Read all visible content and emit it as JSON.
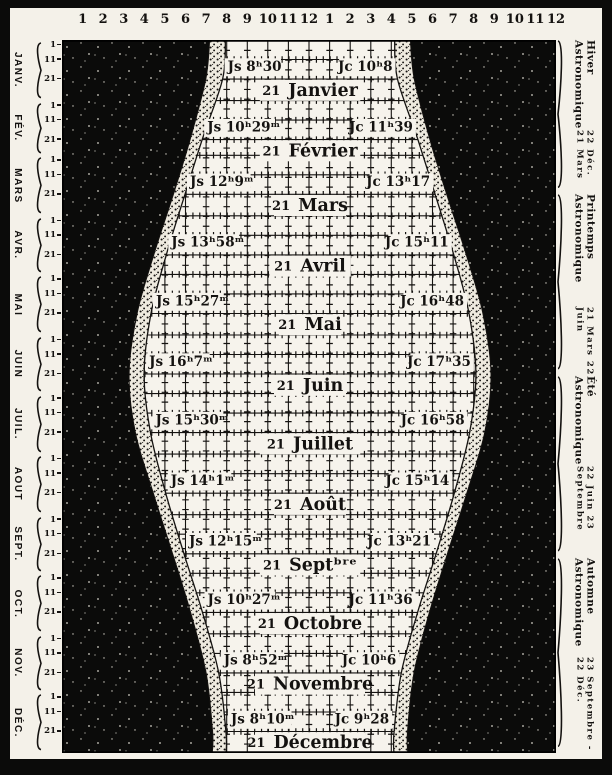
{
  "colors": {
    "paper": "#f4f1e9",
    "day": "#f6f3ec",
    "night": "#0b0b0a",
    "ink": "#141210",
    "speckle": "#d3d0c6"
  },
  "top_axis": {
    "hours": [
      "1",
      "2",
      "3",
      "4",
      "5",
      "6",
      "7",
      "8",
      "9",
      "10",
      "11",
      "12",
      "1",
      "2",
      "3",
      "4",
      "5",
      "6",
      "7",
      "8",
      "9",
      "10",
      "11",
      "12"
    ]
  },
  "left_margin": {
    "tick_labels": [
      "1",
      "11",
      "21"
    ]
  },
  "right_margin": {
    "seasons": [
      {
        "name": "Hiver Astronomique",
        "dates": "22 Déc. 21 Mars",
        "span_days": [
          0,
          79
        ]
      },
      {
        "name": "Printemps Astronomique",
        "dates": "21 Mars 22 Juin",
        "span_days": [
          79,
          172
        ]
      },
      {
        "name": "Été Astronomique",
        "dates": "22 Juin 23 Septembre",
        "span_days": [
          172,
          265
        ]
      },
      {
        "name": "Automne Astronomique",
        "dates": "23 Septembre - 22 Déc.",
        "span_days": [
          265,
          365
        ]
      }
    ]
  },
  "chart_data": {
    "type": "area",
    "x_axis": {
      "unit": "heures",
      "range": [
        0,
        24
      ],
      "tick_labels": [
        "1",
        "2",
        "3",
        "4",
        "5",
        "6",
        "7",
        "8",
        "9",
        "10",
        "11",
        "12",
        "1",
        "2",
        "3",
        "4",
        "5",
        "6",
        "7",
        "8",
        "9",
        "10",
        "11",
        "12"
      ]
    },
    "y_axis": {
      "unit": "jours de l'année",
      "range_days": [
        0,
        365
      ],
      "day_ticks_per_month": [
        "1",
        "11",
        "21"
      ]
    },
    "regions": [
      "nuit",
      "crépuscule",
      "jour"
    ],
    "day_center_hour": 12.05,
    "grid": {
      "vertical_every_hours": 1,
      "horizontal_every_days": 10
    },
    "months": [
      {
        "abbr": "JANV.",
        "name": "Janvier",
        "label_day": "21",
        "start_day": 0,
        "len": 31,
        "js": "Js 8ʰ30",
        "jc": "Jc 10ʰ8",
        "js_hours": 8.5,
        "jc_hours": 10.13
      },
      {
        "abbr": "FÉV.",
        "name": "Février",
        "label_day": "21",
        "start_day": 31,
        "len": 28,
        "js": "Js 10ʰ29ᵐ",
        "jc": "Jc 11ʰ39",
        "js_hours": 10.48,
        "jc_hours": 11.65
      },
      {
        "abbr": "MARS",
        "name": "Mars",
        "label_day": "21",
        "start_day": 59,
        "len": 31,
        "js": "Js 12ʰ9ᵐ",
        "jc": "Jc 13ʰ17",
        "js_hours": 12.15,
        "jc_hours": 13.28
      },
      {
        "abbr": "AVR.",
        "name": "Avril",
        "label_day": "21",
        "start_day": 90,
        "len": 30,
        "js": "Js 13ʰ58ᵐ",
        "jc": "Jc 15ʰ11",
        "js_hours": 13.97,
        "jc_hours": 15.18
      },
      {
        "abbr": "MAI",
        "name": "Mai",
        "label_day": "21",
        "start_day": 120,
        "len": 31,
        "js": "Js 15ʰ27ᵐ",
        "jc": "Jc 16ʰ48",
        "js_hours": 15.45,
        "jc_hours": 16.8
      },
      {
        "abbr": "JUIN",
        "name": "Juin",
        "label_day": "21",
        "start_day": 151,
        "len": 30,
        "js": "Js 16ʰ7ᵐ",
        "jc": "Jc 17ʰ35",
        "js_hours": 16.12,
        "jc_hours": 17.58
      },
      {
        "abbr": "JUIL.",
        "name": "Juillet",
        "label_day": "21",
        "start_day": 181,
        "len": 31,
        "js": "Js 15ʰ30ᵐ",
        "jc": "Jc 16ʰ58",
        "js_hours": 15.5,
        "jc_hours": 16.97
      },
      {
        "abbr": "AOUT",
        "name": "Août",
        "label_day": "21",
        "start_day": 212,
        "len": 31,
        "js": "Js 14ʰ1ᵐ",
        "jc": "Jc 15ʰ14",
        "js_hours": 14.02,
        "jc_hours": 15.23
      },
      {
        "abbr": "SEPT.",
        "name": "Septᵇʳᵉ",
        "label_day": "21",
        "start_day": 243,
        "len": 30,
        "js": "Js 12ʰ15ᵐ",
        "jc": "Jc 13ʰ21",
        "js_hours": 12.25,
        "jc_hours": 13.35
      },
      {
        "abbr": "OCT.",
        "name": "Octobre",
        "label_day": "21",
        "start_day": 273,
        "len": 31,
        "js": "Js 10ʰ27ᵐ",
        "jc": "Jc 11ʰ36",
        "js_hours": 10.45,
        "jc_hours": 11.6
      },
      {
        "abbr": "NOV.",
        "name": "Novembre",
        "label_day": "21",
        "start_day": 304,
        "len": 30,
        "js": "Js 8ʰ52ᵐ",
        "jc": "Jc 10ʰ6",
        "js_hours": 8.87,
        "jc_hours": 10.1
      },
      {
        "abbr": "DÉC.",
        "name": "Décembre",
        "label_day": "21",
        "start_day": 334,
        "len": 31,
        "js": "Js 8ʰ10ᵐ",
        "jc": "Jc 9ʰ28",
        "js_hours": 8.17,
        "jc_hours": 9.47
      }
    ],
    "curve_endpoints": {
      "start": {
        "js": 8.22,
        "jc": 9.75
      },
      "end": {
        "js": 8.15,
        "jc": 9.5
      }
    }
  }
}
